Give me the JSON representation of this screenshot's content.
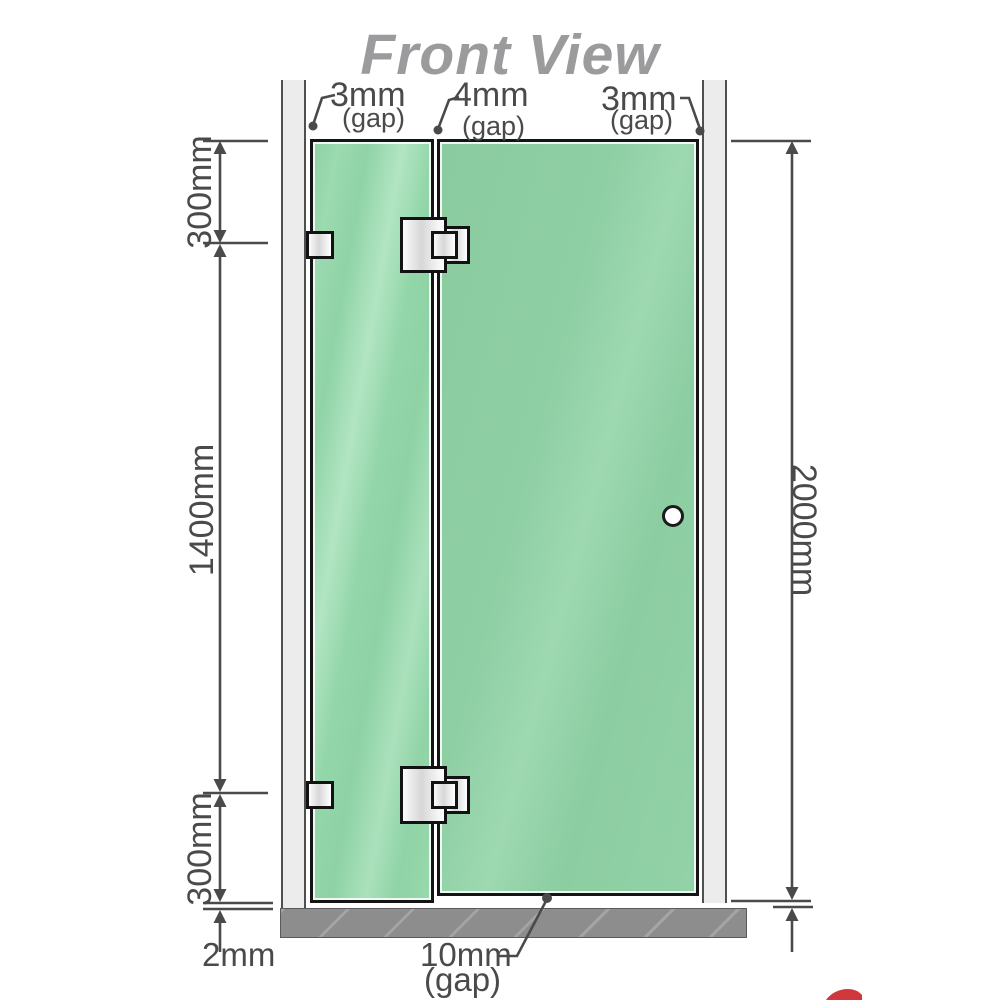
{
  "title": "Front View",
  "annotations": {
    "gap_left": {
      "value": "3mm",
      "note": "(gap)"
    },
    "gap_middle": {
      "value": "4mm",
      "note": "(gap)"
    },
    "gap_right": {
      "value": "3mm",
      "note": "(gap)"
    },
    "gap_bottom": {
      "value": "10mm",
      "note": "(gap)"
    },
    "floor_clearance": "2mm"
  },
  "dimensions": {
    "left_top": "300mm",
    "left_middle": "1400mm",
    "left_bottom": "300mm",
    "right_overall": "2000mm"
  },
  "colors": {
    "glass_fixed": "#8fd2a6",
    "glass_door": "#8ccda2",
    "wall": "#ececec",
    "base": "#8d8d8d",
    "line": "#4a4a4a",
    "title": "#9b9b9d",
    "hardware": "#e8e8e8",
    "accent_red": "#cc2229"
  }
}
